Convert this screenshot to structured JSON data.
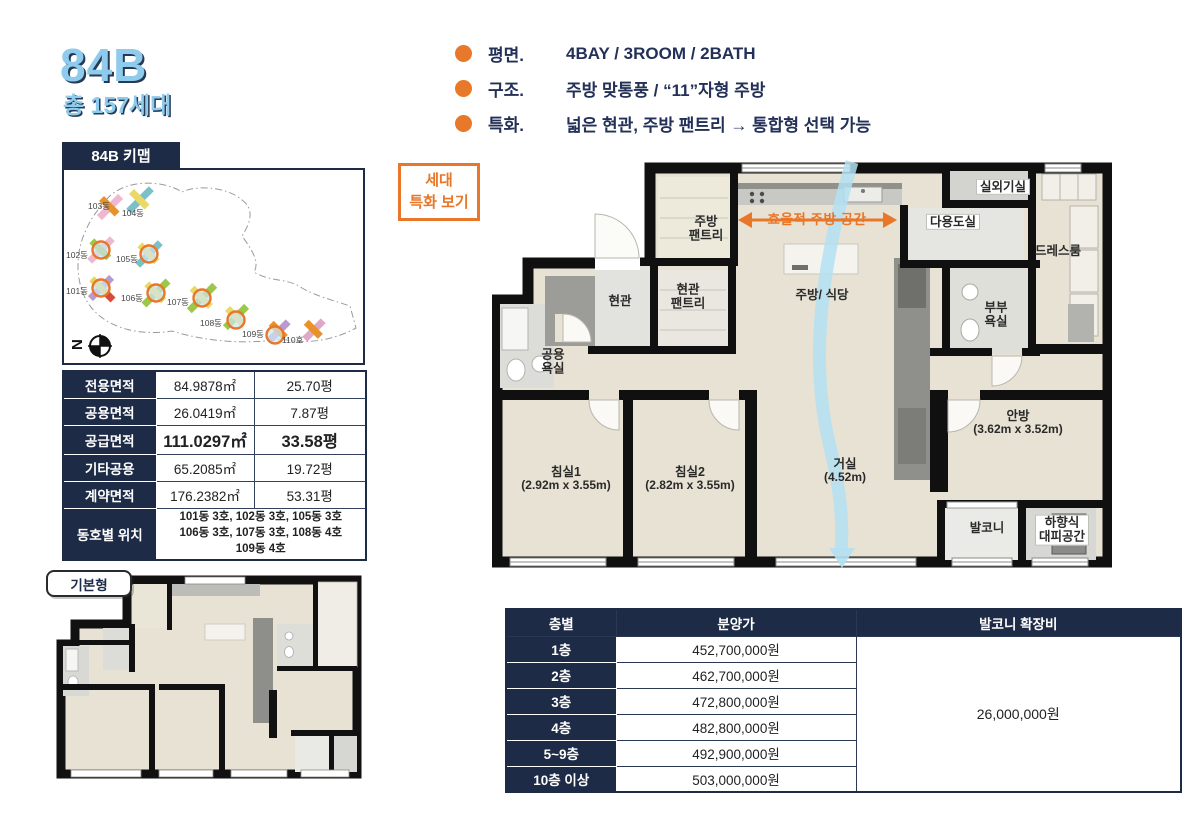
{
  "header": {
    "unit": "84B",
    "households": "총 157세대"
  },
  "features": [
    {
      "label": "평면.",
      "value": "4BAY / 3ROOM / 2BATH"
    },
    {
      "label": "구조.",
      "value": "주방 맞통풍 / “11”자형 주방"
    },
    {
      "label": "특화.",
      "value": "넓은 현관, 주방 팬트리 → 통합형 선택 가능"
    }
  ],
  "keymap": {
    "title": "84B 키맵",
    "compass": "N",
    "buildings": [
      {
        "name": "103동",
        "circled": false
      },
      {
        "name": "104동",
        "circled": false
      },
      {
        "name": "102동",
        "circled": true
      },
      {
        "name": "105동",
        "circled": true
      },
      {
        "name": "101동",
        "circled": true
      },
      {
        "name": "106동",
        "circled": true
      },
      {
        "name": "107동",
        "circled": true
      },
      {
        "name": "108동",
        "circled": true
      },
      {
        "name": "109동",
        "circled": true
      },
      {
        "name": "110호",
        "circled": false
      }
    ]
  },
  "area_table": {
    "rows": [
      {
        "label": "전용면적",
        "sqm": "84.9878㎡",
        "py": "25.70평"
      },
      {
        "label": "공용면적",
        "sqm": "26.0419㎡",
        "py": "7.87평"
      },
      {
        "label": "공급면적",
        "sqm": "111.0297㎡",
        "py": "33.58평"
      },
      {
        "label": "기타공용",
        "sqm": "65.2085㎡",
        "py": "19.72평"
      },
      {
        "label": "계약면적",
        "sqm": "176.2382㎡",
        "py": "53.31평"
      }
    ],
    "location": {
      "label": "동호별 위치",
      "lines": [
        "101동 3호, 102동 3호, 105동 3호",
        "106동 3호, 107동 3호, 108동 4호",
        "109동 4호"
      ]
    }
  },
  "base_plan": {
    "label": "기본형"
  },
  "floorplan": {
    "special_button": [
      "세대",
      "특화 보기"
    ],
    "kitchen_arrow": "효율적 주방 공간",
    "labels": {
      "kitchen_pantry": [
        "주방",
        "팬트리"
      ],
      "entrance": [
        "현관"
      ],
      "entrance_pantry": [
        "현관",
        "팬트리"
      ],
      "common_bath": [
        "공용",
        "욕실"
      ],
      "kitchen_dining": [
        "주방/ 식당"
      ],
      "utility": [
        "다용도실"
      ],
      "outdoor_unit": [
        "실외기실"
      ],
      "dress_room": [
        "드레스룸"
      ],
      "couple_bath": [
        "부부",
        "욕실"
      ],
      "master_bedroom": [
        "안방",
        "(3.62m x 3.52m)"
      ],
      "bedroom1": [
        "침실1",
        "(2.92m x 3.55m)"
      ],
      "bedroom2": [
        "침실2",
        "(2.82m x 3.55m)"
      ],
      "living": [
        "거실",
        "(4.52m)"
      ],
      "balcony": [
        "발코니"
      ],
      "escape": [
        "하향식",
        "대피공간"
      ]
    }
  },
  "price_table": {
    "headers": [
      "층별",
      "분양가",
      "발코니 확장비"
    ],
    "rows": [
      [
        "1층",
        "452,700,000원"
      ],
      [
        "2층",
        "462,700,000원"
      ],
      [
        "3층",
        "472,800,000원"
      ],
      [
        "4층",
        "482,800,000원"
      ],
      [
        "5~9층",
        "492,900,000원"
      ],
      [
        "10층 이상",
        "503,000,000원"
      ]
    ],
    "balcony_cost": "26,000,000원"
  },
  "colors": {
    "navy": "#1e2b46",
    "orange": "#e8772a",
    "title_blue": "#8fcbec",
    "floor_beige": "#e7e2d3"
  }
}
